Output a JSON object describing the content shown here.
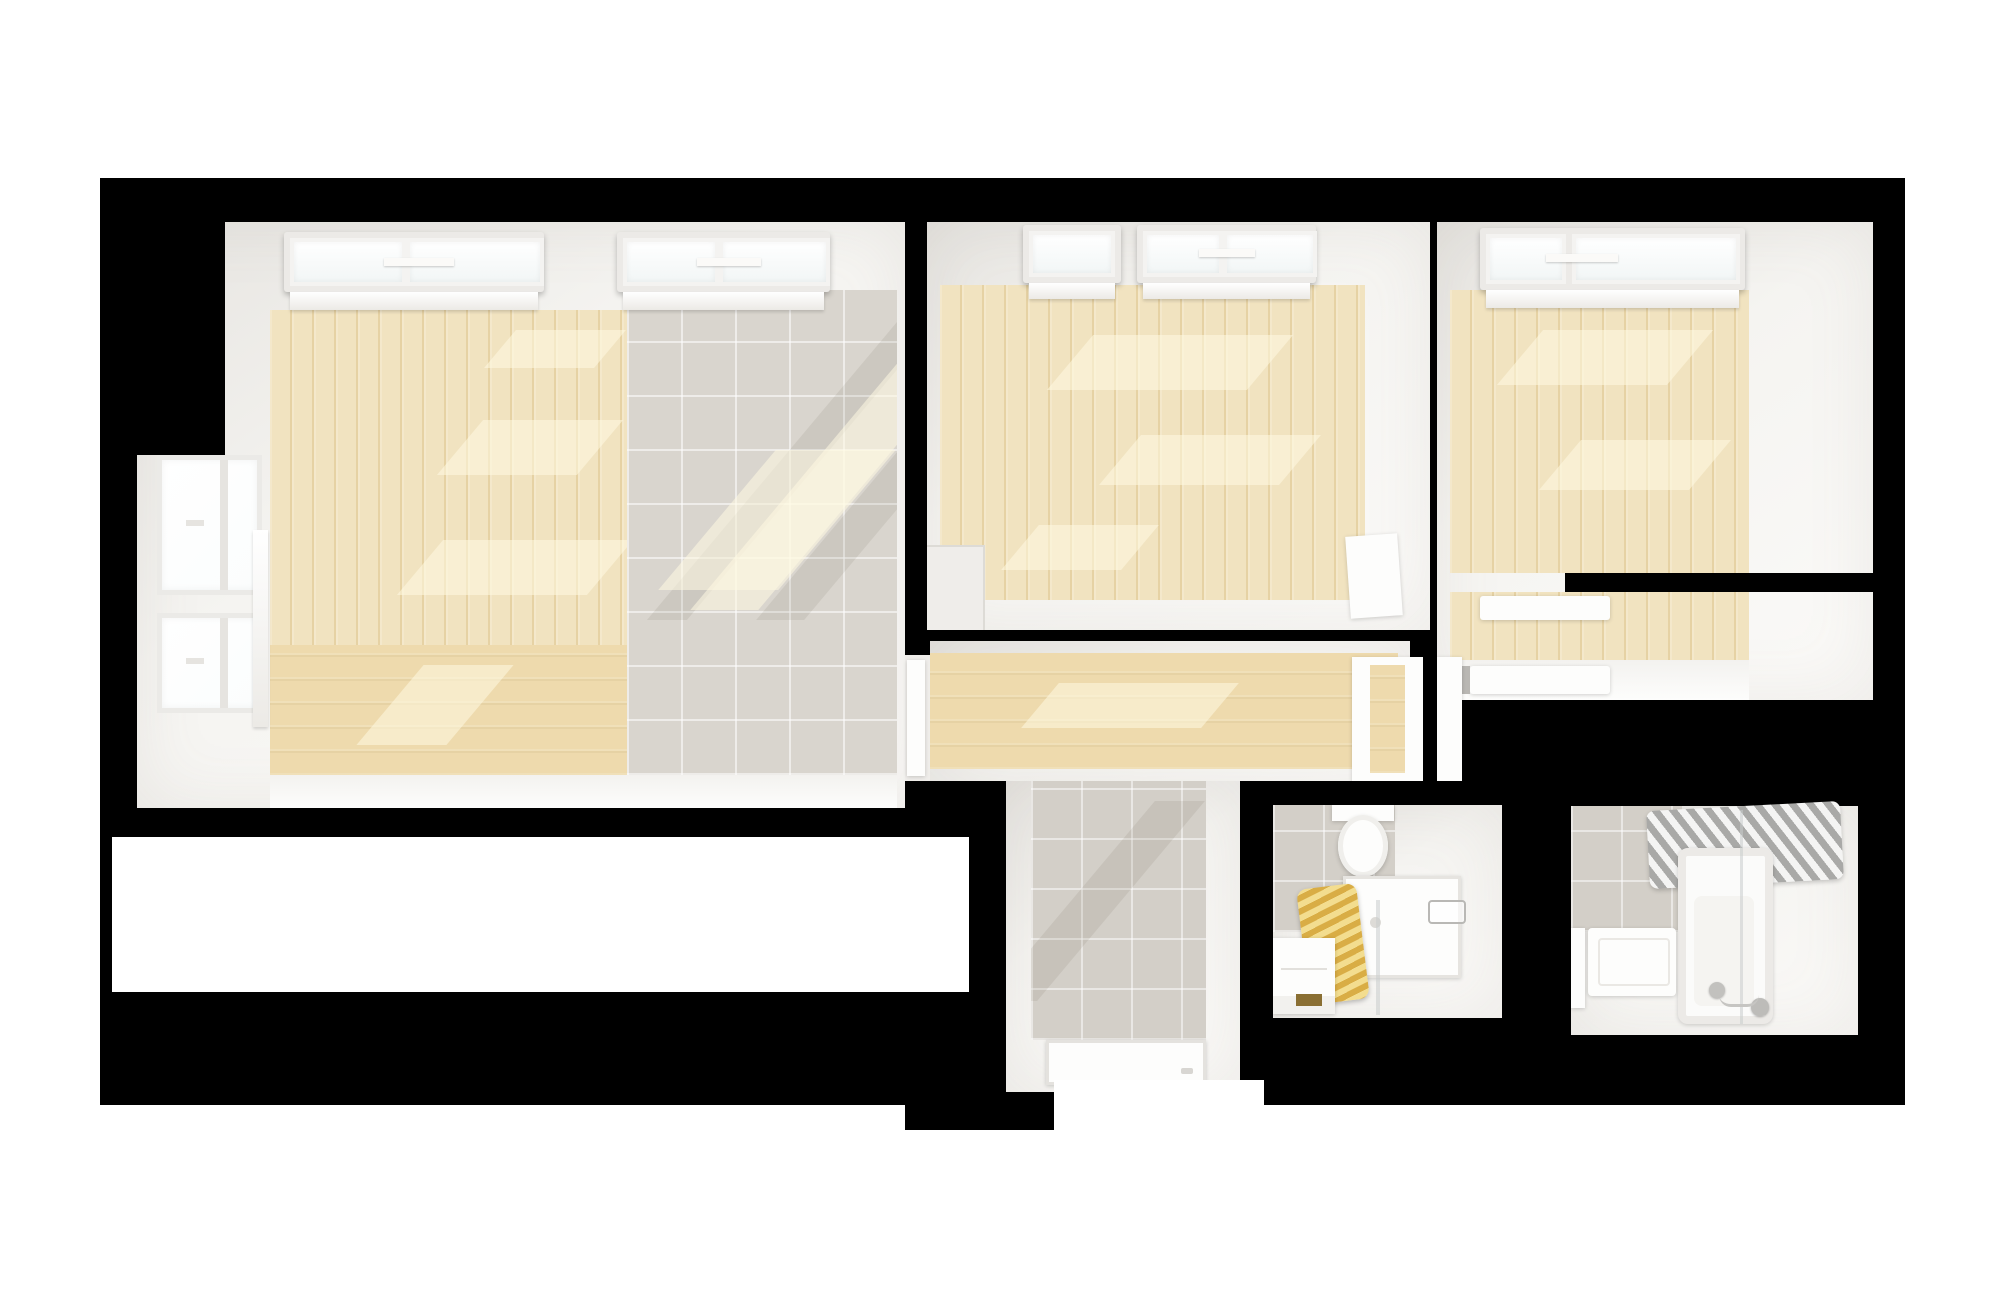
{
  "scene": {
    "type": "architectural-floor-plan-3d-render",
    "view": "top-down dollhouse",
    "rooms": [
      {
        "name": "living-room",
        "floor": "light wood planks and gray tile",
        "features": [
          "two double skylights",
          "two windows on left wall",
          "sunlight patches"
        ]
      },
      {
        "name": "bedroom-1",
        "floor": "light wood planks",
        "features": [
          "two skylights",
          "leaning white panel",
          "door notch to hallway"
        ]
      },
      {
        "name": "bedroom-2",
        "floor": "light wood planks",
        "features": [
          "double skylight",
          "wardrobe nook with shelves",
          "interior partition wall"
        ]
      },
      {
        "name": "hallway",
        "floor": "light wood planks (horizontal)",
        "features": [
          "door to living room",
          "glazed door to bedroom-2 nook"
        ]
      },
      {
        "name": "shower-corridor",
        "floor": "gray tile",
        "features": [
          "white shower tray"
        ]
      },
      {
        "name": "wc-shower-room",
        "floor": "gray tile and white",
        "features": [
          "toilet",
          "gold towel radiator",
          "shower tray with glass screen",
          "vanity cabinet",
          "faucet fittings"
        ]
      },
      {
        "name": "bathroom",
        "floor": "white tile",
        "features": [
          "chrome towel radiator",
          "bathtub with glass screen",
          "washbasin",
          "bath faucet with hand shower"
        ]
      },
      {
        "name": "empty-room",
        "floor": "blank white (unrendered)",
        "features": []
      }
    ]
  },
  "palette": {
    "background": "#ffffff",
    "structure_black": "#000000",
    "wall_white": "#f5f4f1",
    "wall_shadow": "#e7e5e1",
    "floor_wood_light": "#f1e3c0",
    "floor_wood_dark": "#e6d2a4",
    "floor_wood_hall": "#eedaad",
    "floor_tile": "#d9d5ce",
    "floor_tile_corridor": "#d3cfc8",
    "floor_glow": "#f3f2ef",
    "skylight_frame": "#eceae7",
    "glass_sky": "#f2f6f6",
    "glass_window": "#fbfdfd",
    "glass_screen": "rgba(200,204,204,0.55)",
    "fixture_white": "#fdfdfc",
    "gold_towel_rail": "#d9ad45",
    "gold_towel_rail_light": "#f3dd8f",
    "chrome_towel_rail": "#a9a9a7",
    "sunlight": "rgba(255,249,226,0.55)",
    "shadow": "rgba(95,85,72,0.10)"
  }
}
